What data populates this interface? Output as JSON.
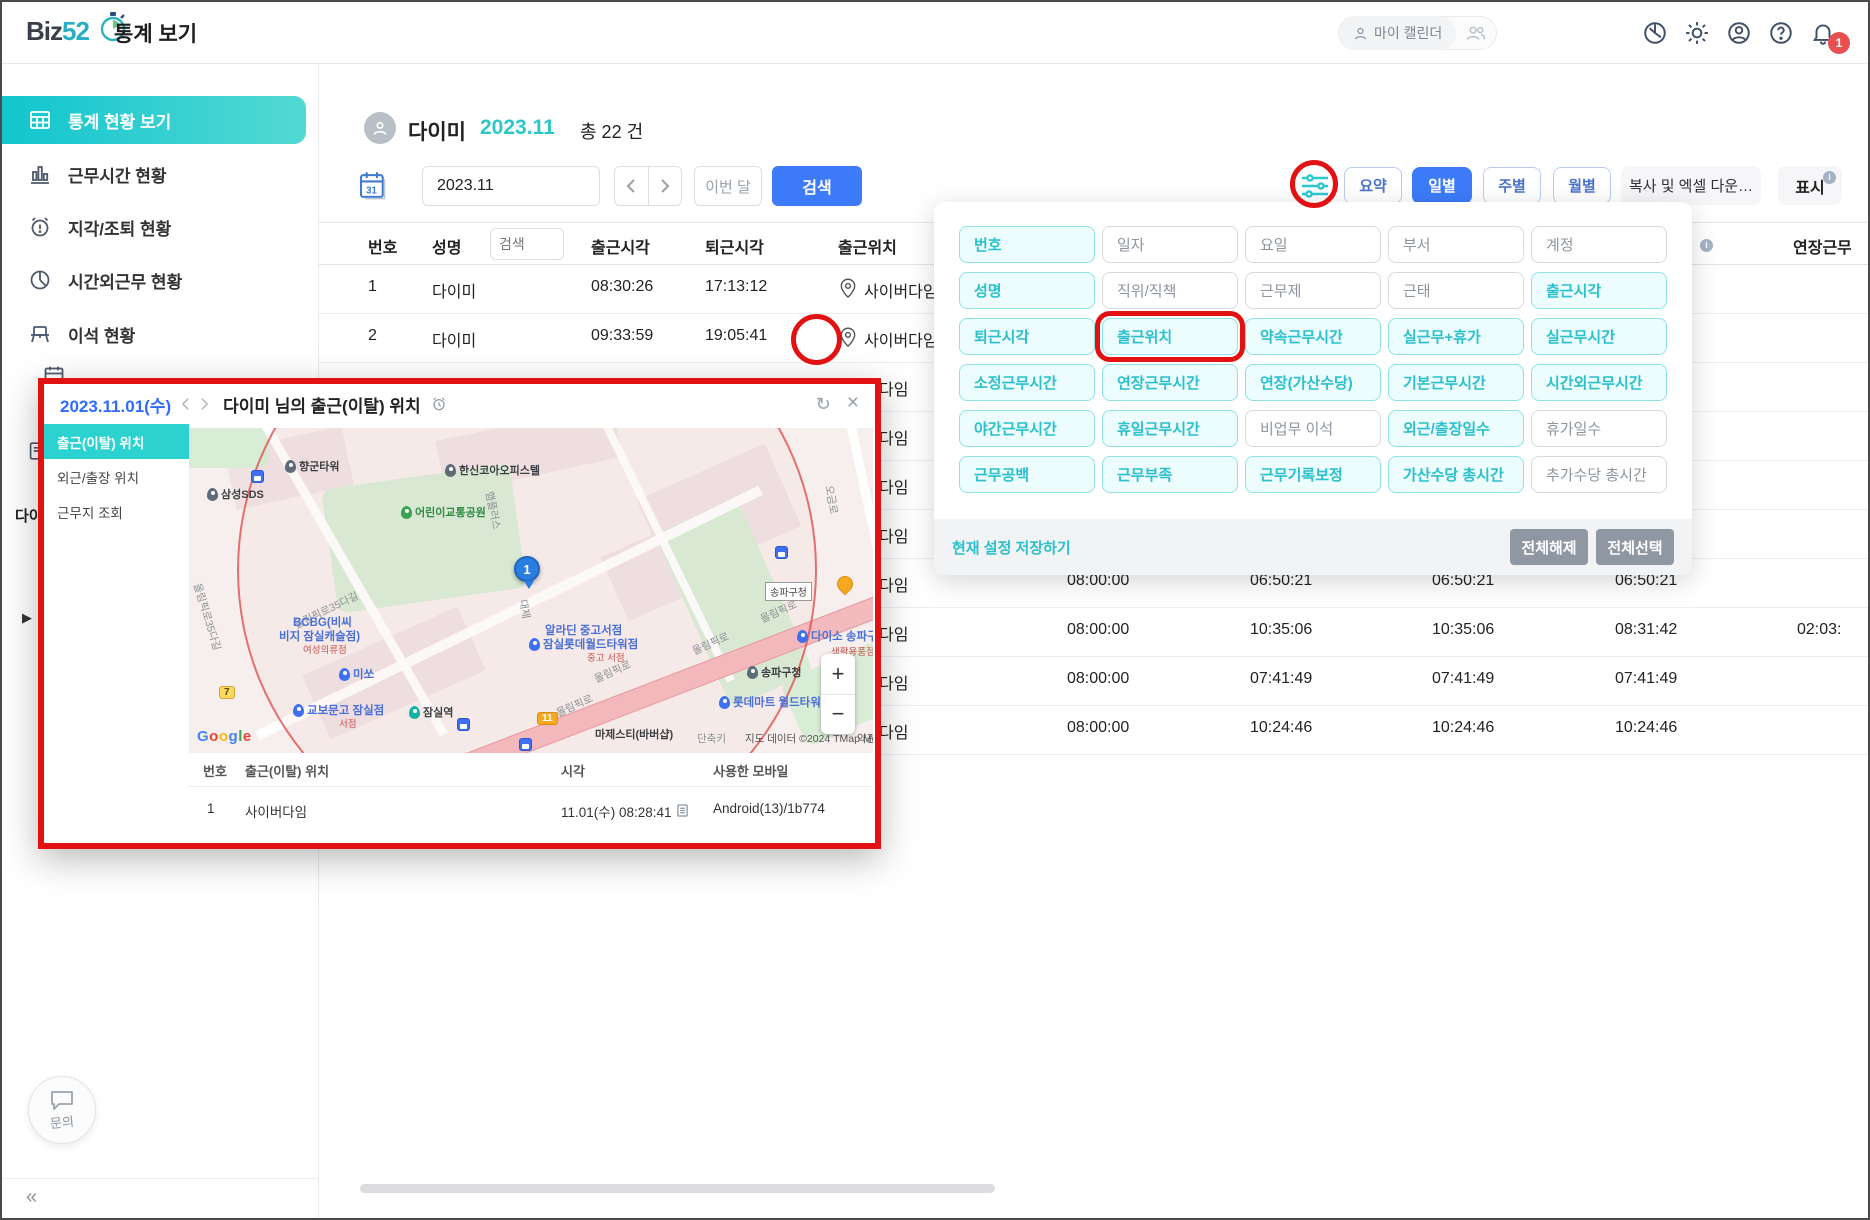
{
  "app": {
    "logo_prefix": "Biz",
    "logo_num": "52",
    "title": "통계 보기"
  },
  "topbar": {
    "my_calendar": "마이 캘린더",
    "badge": "1"
  },
  "sidebar": {
    "items": [
      {
        "label": "통계 현황 보기",
        "active": true
      },
      {
        "label": "근무시간 현황"
      },
      {
        "label": "지각/조퇴 현황"
      },
      {
        "label": "시간외근무 현황"
      },
      {
        "label": "이석 현황"
      }
    ],
    "fragment": "다이",
    "inquiry": "문의"
  },
  "user_header": {
    "name": "다이미",
    "period": "2023.11",
    "total": "총 22 건"
  },
  "controls": {
    "date_value": "2023.11",
    "this_month": "이번 달",
    "search": "검색",
    "views": [
      {
        "label": "요약"
      },
      {
        "label": "일별",
        "active": true
      },
      {
        "label": "주별"
      },
      {
        "label": "월별"
      }
    ],
    "copy_excel": "복사 및 엑셀 다운…",
    "display": "표시"
  },
  "table": {
    "headers": {
      "no": "번호",
      "name": "성명",
      "in": "출근시각",
      "out": "퇴근시각",
      "loc": "출근위치",
      "overflow": "연장근무"
    },
    "search_placeholder": "검색",
    "rows": [
      {
        "no": "1",
        "name": "다이미",
        "in": "08:30:26",
        "out": "17:13:12",
        "loc": "사이버다임"
      },
      {
        "no": "2",
        "name": "다이미",
        "in": "09:33:59",
        "out": "19:05:41",
        "loc": "사이버다임"
      },
      {
        "frag": "다임"
      },
      {
        "frag": "다임"
      },
      {
        "frag": "다임"
      },
      {
        "frag": "다임"
      },
      {
        "frag": "다임",
        "v1": "08:00:00",
        "v2": "06:50:21",
        "v3": "06:50:21",
        "v4": "06:50:21"
      },
      {
        "frag": "다임",
        "v1": "08:00:00",
        "v2": "10:35:06",
        "v3": "10:35:06",
        "v4": "08:31:42",
        "v5": "02:03:"
      },
      {
        "frag": "다임",
        "v1": "08:00:00",
        "v2": "07:41:49",
        "v3": "07:41:49",
        "v4": "07:41:49"
      },
      {
        "frag": "다임",
        "v1": "08:00:00",
        "v2": "10:24:46",
        "v3": "10:24:46",
        "v4": "10:24:46"
      }
    ]
  },
  "filter_panel": {
    "grid": [
      {
        "label": "번호",
        "on": true
      },
      {
        "label": "일자"
      },
      {
        "label": "요일"
      },
      {
        "label": "부서"
      },
      {
        "label": "계정"
      },
      {
        "label": "성명",
        "on": true
      },
      {
        "label": "직위/직책"
      },
      {
        "label": "근무제"
      },
      {
        "label": "근태"
      },
      {
        "label": "출근시각",
        "on": true
      },
      {
        "label": "퇴근시각",
        "on": true
      },
      {
        "label": "출근위치",
        "on": true,
        "boxed": true
      },
      {
        "label": "약속근무시간",
        "on": true
      },
      {
        "label": "실근무+휴가",
        "on": true
      },
      {
        "label": "실근무시간",
        "on": true
      },
      {
        "label": "소정근무시간",
        "on": true
      },
      {
        "label": "연장근무시간",
        "on": true
      },
      {
        "label": "연장(가산수당)",
        "on": true
      },
      {
        "label": "기본근무시간",
        "on": true
      },
      {
        "label": "시간외근무시간",
        "on": true
      },
      {
        "label": "야간근무시간",
        "on": true
      },
      {
        "label": "휴일근무시간",
        "on": true
      },
      {
        "label": "비업무 이석"
      },
      {
        "label": "외근/출장일수",
        "on": true
      },
      {
        "label": "휴가일수"
      },
      {
        "label": "근무공백",
        "on": true
      },
      {
        "label": "근무부족",
        "on": true
      },
      {
        "label": "근무기록보정",
        "on": true
      },
      {
        "label": "가산수당 총시간",
        "on": true
      },
      {
        "label": "추가수당 총시간"
      }
    ],
    "save": "현재 설정 저장하기",
    "deselect_all": "전체해제",
    "select_all": "전체선택"
  },
  "popup": {
    "date": "2023.11.01(수)",
    "title": "다이미 님의 출근(이탈) 위치",
    "tabs": [
      {
        "label": "출근(이탈) 위치",
        "active": true
      },
      {
        "label": "외근/출장 위치"
      },
      {
        "label": "근무지 조회"
      }
    ],
    "map": {
      "marker": "1",
      "google": "Google",
      "shortcut": "단축키",
      "attribution": "지도 데이터 ©2024 TMap Mobility",
      "terms": "약관",
      "labels": [
        {
          "t": "향군타워",
          "x": 96,
          "y": 30,
          "c": "dark",
          "pin": "#5f6b7a"
        },
        {
          "t": "삼성SDS",
          "x": 18,
          "y": 58,
          "c": "dark",
          "pin": "#5f6b7a"
        },
        {
          "t": "",
          "x": 62,
          "y": 42,
          "c": "transit"
        },
        {
          "t": "한신코아오피스텔",
          "x": 256,
          "y": 34,
          "c": "dark",
          "pin": "#5f6b7a"
        },
        {
          "t": "어린이교통공원",
          "x": 212,
          "y": 76,
          "c": "green",
          "pin": "#36a451"
        },
        {
          "t": "햄플러스",
          "x": 300,
          "y": 56,
          "c": "road",
          "rot": 78
        },
        {
          "t": "올림픽로35다길",
          "x": 8,
          "y": 148,
          "c": "road",
          "rot": 73
        },
        {
          "t": "올림픽로35다길",
          "x": 106,
          "y": 190,
          "c": "road",
          "rot": -26
        },
        {
          "t": "오금로",
          "x": 640,
          "y": 50,
          "c": "road",
          "rot": 80
        },
        {
          "t": "",
          "x": 586,
          "y": 118,
          "c": "transit"
        },
        {
          "t": "BCBG(비씨",
          "x": 104,
          "y": 186,
          "c": "blue"
        },
        {
          "t": "비지 잠실캐슬점)",
          "x": 90,
          "y": 200,
          "c": "blue"
        },
        {
          "t": "여성의류점",
          "x": 114,
          "y": 214,
          "c": "reds"
        },
        {
          "t": "미쏘",
          "x": 150,
          "y": 238,
          "c": "blue",
          "pin": "#3f6ff2"
        },
        {
          "t": "교보문고 잠실점",
          "x": 104,
          "y": 274,
          "c": "blue",
          "pin": "#3f6ff2"
        },
        {
          "t": "서점",
          "x": 150,
          "y": 288,
          "c": "reds"
        },
        {
          "t": "잠실역",
          "x": 220,
          "y": 276,
          "c": "dark",
          "pin": "#12b3a6"
        },
        {
          "t": "",
          "x": 268,
          "y": 290,
          "c": "transit"
        },
        {
          "t": "",
          "x": 330,
          "y": 310,
          "c": "transit"
        },
        {
          "t": "알라딘 중고서점",
          "x": 356,
          "y": 194,
          "c": "blue"
        },
        {
          "t": "잠실롯데월드타워점",
          "x": 340,
          "y": 208,
          "c": "blue",
          "pin": "#3f6ff2"
        },
        {
          "t": "중고 서점",
          "x": 398,
          "y": 222,
          "c": "reds"
        },
        {
          "t": "대제",
          "x": 334,
          "y": 164,
          "c": "road",
          "rot": 80
        },
        {
          "t": "올림픽로",
          "x": 368,
          "y": 278,
          "c": "road",
          "rot": -24
        },
        {
          "t": "올림픽로",
          "x": 406,
          "y": 244,
          "c": "road",
          "rot": -24
        },
        {
          "t": "올림픽로",
          "x": 504,
          "y": 216,
          "c": "road",
          "rot": -24
        },
        {
          "t": "올림픽로",
          "x": 572,
          "y": 184,
          "c": "road",
          "rot": -24
        },
        {
          "t": "송파구청",
          "x": 576,
          "y": 154,
          "c": "badge"
        },
        {
          "t": "",
          "x": 648,
          "y": 148,
          "c": "food"
        },
        {
          "t": "송파구청",
          "x": 558,
          "y": 236,
          "c": "dark",
          "pin": "#5f6b7a"
        },
        {
          "t": "다이소 송파구청점",
          "x": 608,
          "y": 200,
          "c": "blue",
          "pin": "#3f6ff2"
        },
        {
          "t": "생활용품점",
          "x": 642,
          "y": 216,
          "c": "reds"
        },
        {
          "t": "롯데마트 월드타워점",
          "x": 530,
          "y": 266,
          "c": "blue",
          "pin": "#3f6ff2"
        },
        {
          "t": "마제스티(바버샵)",
          "x": 406,
          "y": 298,
          "c": "dark"
        },
        {
          "t": "7",
          "x": 30,
          "y": 258,
          "c": "badgey"
        },
        {
          "t": "11",
          "x": 348,
          "y": 284,
          "c": "badgeo"
        }
      ]
    },
    "table": {
      "headers": {
        "no": "번호",
        "loc": "출근(이탈) 위치",
        "time": "시각",
        "device": "사용한 모바일"
      },
      "row": {
        "no": "1",
        "loc": "사이버다임",
        "time": "11.01(수) 08:28:41",
        "device": "Android(13)/1b774"
      }
    }
  },
  "icons": {
    "refresh": "↻",
    "close": "×",
    "collapse": "«",
    "expander": "▶",
    "plus": "+",
    "minus": "−"
  }
}
